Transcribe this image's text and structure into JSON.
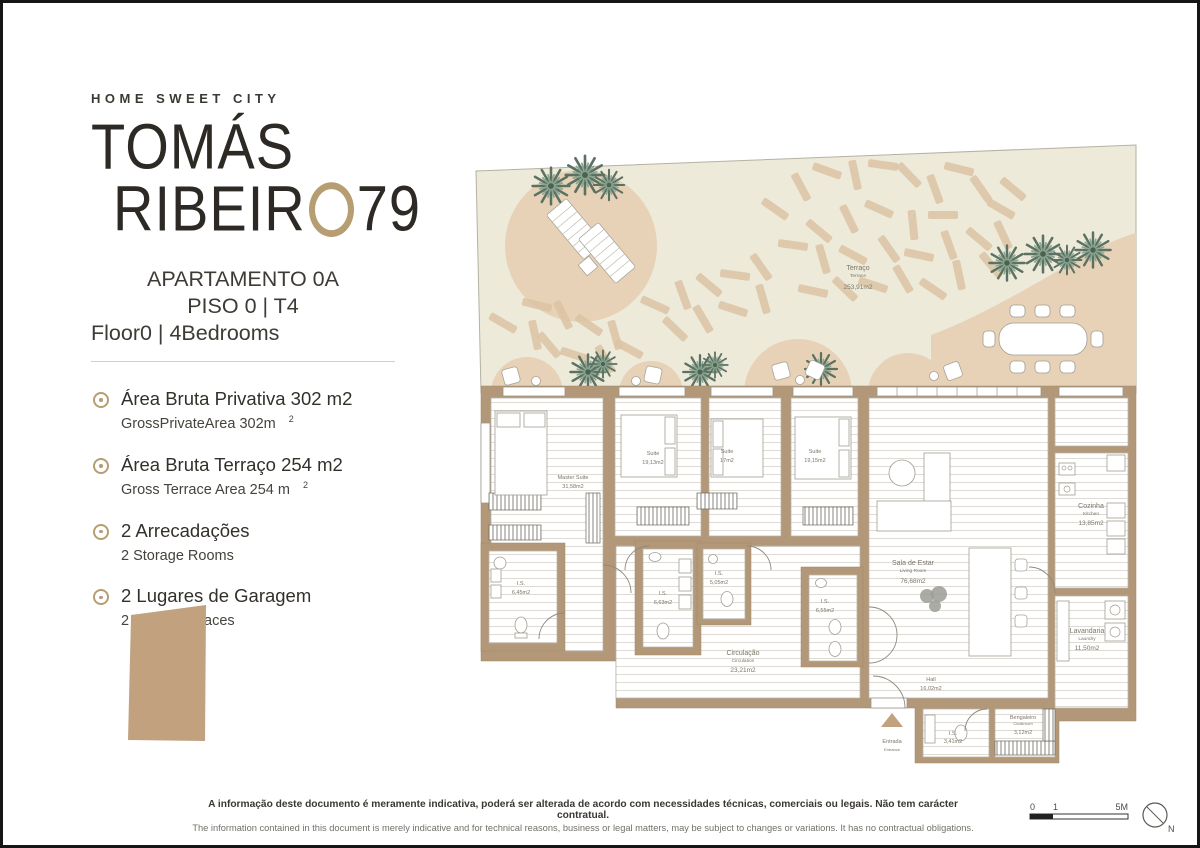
{
  "brand": {
    "tagline": "HOME SWEET CITY",
    "name_line1": "TOMÁS",
    "name_line2_left": "RIBEIR",
    "name_line2_right": "79"
  },
  "apartment": {
    "line1": "APARTAMENTO 0A",
    "line2": "PISO 0 | T4",
    "line3": "Floor0 | 4Bedrooms"
  },
  "features": [
    {
      "pt": "Área Bruta Privativa 302 m2",
      "en": "GrossPrivateArea 302m",
      "sup": "2"
    },
    {
      "pt": "Área Bruta Terraço 254 m2",
      "en": "Gross Terrace Area 254 m",
      "sup": "2"
    },
    {
      "pt": "2 Arrecadações",
      "en": "2 Storage Rooms",
      "sup": ""
    },
    {
      "pt": "2 Lugares de Garagem",
      "en": "2 Parking Spaces",
      "sup": ""
    }
  ],
  "rooms": {
    "terrace": {
      "pt": "Terraço",
      "en": "Terrace",
      "area": "253,91m2"
    },
    "master": {
      "pt": "Master Suite",
      "area": "31,58m2"
    },
    "suite2": {
      "pt": "Suite",
      "area": "19,13m2"
    },
    "suite3": {
      "pt": "Suite",
      "area": "17m2"
    },
    "suite4": {
      "pt": "Suite",
      "area": "19,15m2"
    },
    "is1": {
      "pt": "I.S.",
      "area": "6,45m2"
    },
    "is2": {
      "pt": "I.S.",
      "area": "6,63m2"
    },
    "is3": {
      "pt": "I.S.",
      "area": "5,05m2"
    },
    "is4": {
      "pt": "I.S.",
      "area": "6,55m2"
    },
    "circulation": {
      "pt": "Circulação",
      "en": "Circulation",
      "area": "23,21m2"
    },
    "living": {
      "pt": "Sala de Estar",
      "en": "Living Room",
      "area": "76,68m2"
    },
    "kitchen": {
      "pt": "Cozinha",
      "en": "Kitchen",
      "area": "13,85m2"
    },
    "laundry": {
      "pt": "Lavandaria",
      "en": "Laundry",
      "area": "11,50m2"
    },
    "hall": {
      "pt": "Hall",
      "area": "16,02m2"
    },
    "is5": {
      "pt": "I.S.",
      "area": "3,41m2"
    },
    "cloak": {
      "pt": "Bengaleiro",
      "en": "Cloakroom",
      "area": "3,12m2"
    }
  },
  "entrance": {
    "pt": "Entrada",
    "en": "Entrance"
  },
  "disclaimer": {
    "pt": "A informação deste documento é meramente indicativa, poderá ser alterada de acordo com necessidades técnicas, comerciais ou legais. Não tem carácter contratual.",
    "en": "The information contained in this document is merely indicative and for technical reasons, business or legal matters, may be subject to changes or variations. It has no contractual obligations."
  },
  "scale": {
    "t0": "0",
    "t1": "1",
    "t2": "5M",
    "north": "N"
  },
  "colors": {
    "accent_ring": "#b79d72",
    "wall": "#b29878",
    "terrace_bg": "#edead9",
    "deck_plank": "#dcc3a3",
    "planter": "#e7d2b7",
    "key_shape": "#c2a17f",
    "palm_green": "#5b7263",
    "text_dark": "#2d2a25"
  }
}
